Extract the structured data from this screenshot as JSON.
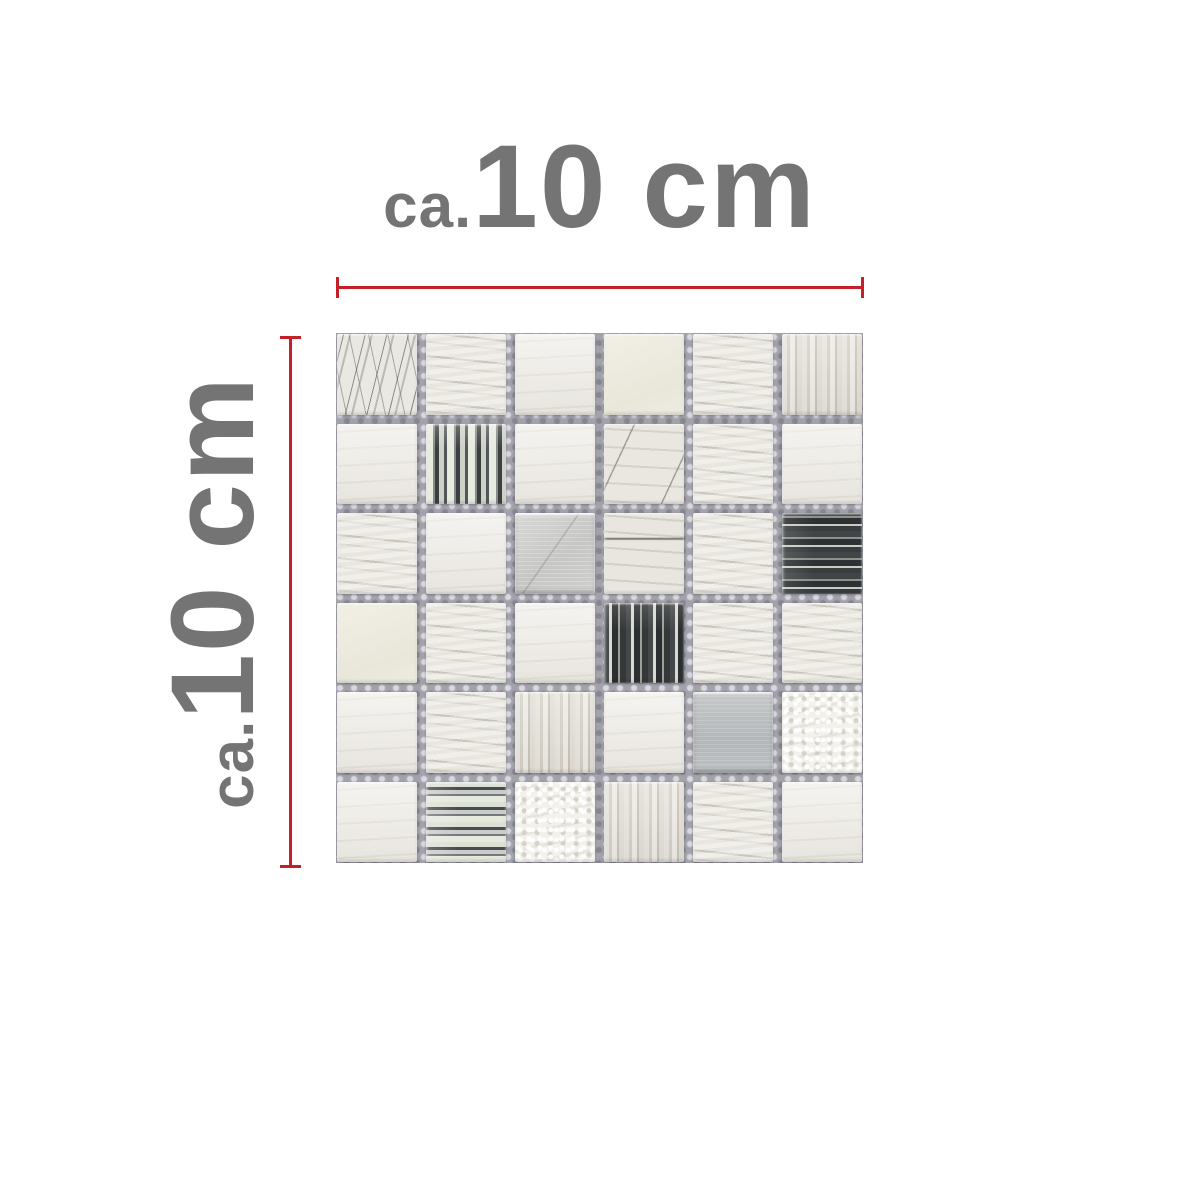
{
  "page": {
    "background": "#ffffff"
  },
  "annotations": {
    "top": {
      "prefix": "ca.",
      "value": "10 cm"
    },
    "left": {
      "prefix": "ca.",
      "value": "10 cm"
    },
    "text_color": "#747474",
    "line_color": "#c32127"
  },
  "mosaic": {
    "rows": 6,
    "cols": 6,
    "grout_color": "#a3a2ab",
    "palette": {
      "stone_light": "#ebe8e1",
      "stone_vein": "#8f8a82",
      "metal_bright": "#cccdcb",
      "metal_dark": "#b8bcbe",
      "glass_dark": "#3a3d3f",
      "glass_silver": "#dfe3d8",
      "cream": "#edebdf"
    },
    "tiles": [
      "stone-marble",
      "stone-veined",
      "stone-plain",
      "cream",
      "stone-veined",
      "stone-striped",
      "stone-plain",
      "glass-v-bright",
      "stone-plain",
      "stone-scratch",
      "stone-veined",
      "stone-plain",
      "stone-veined",
      "stone-plain",
      "metal-bright",
      "stone-vein-line",
      "stone-veined",
      "glass-h-dark",
      "cream",
      "stone-veined",
      "stone-plain",
      "glass-v-dark",
      "stone-veined",
      "stone-veined",
      "stone-plain",
      "stone-veined",
      "stone-striped",
      "stone-plain",
      "metal-dark",
      "stone-rough",
      "stone-plain",
      "glass-h-bright",
      "stone-rough",
      "stone-striped",
      "stone-veined",
      "stone-plain"
    ]
  }
}
